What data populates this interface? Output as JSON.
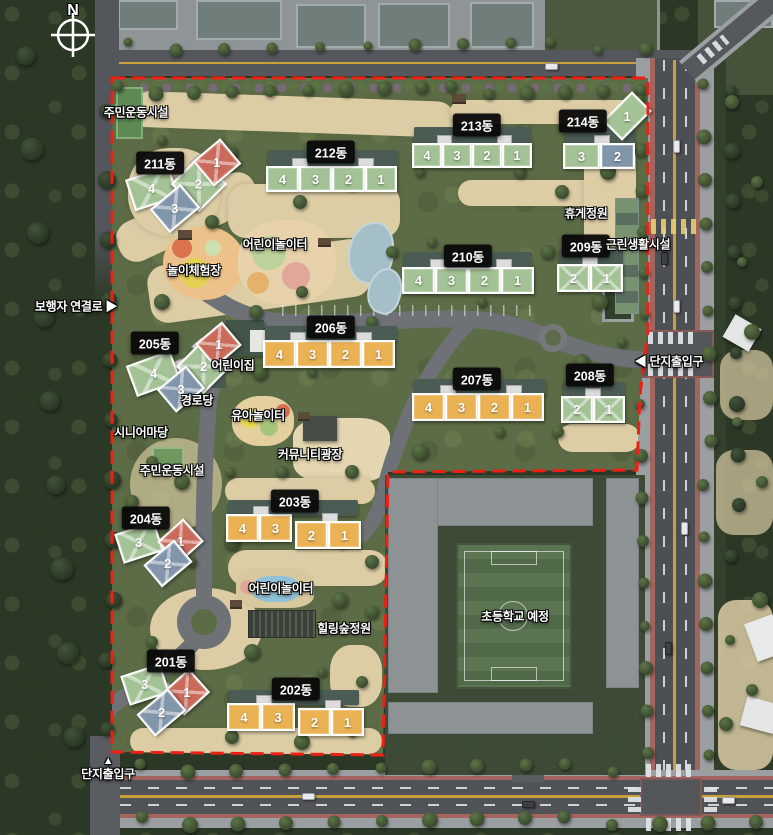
{
  "meta": {
    "compass": "N"
  },
  "colors": {
    "green": "#a3c295",
    "orange": "#ebb254",
    "red": "#c96a5a",
    "blue": "#8196aa",
    "boundary": "#ee1f14",
    "label_bg": "#0c0c0c"
  },
  "buildings": [
    {
      "name": "211동",
      "label": {
        "x": 160,
        "y": 163
      },
      "units": [
        {
          "n": "4",
          "c": "green",
          "x": 129,
          "y": 172,
          "w": 46,
          "h": 33,
          "r": -18,
          "cross": true
        },
        {
          "n": "2",
          "c": "green",
          "x": 179,
          "y": 164,
          "w": 40,
          "h": 40,
          "r": 45,
          "cross": true
        },
        {
          "n": "3",
          "c": "blue",
          "x": 155,
          "y": 193,
          "w": 40,
          "h": 31,
          "r": -40,
          "cross": true
        },
        {
          "n": "1",
          "c": "red",
          "x": 199,
          "y": 146,
          "w": 36,
          "h": 33,
          "r": -40,
          "cross": true
        }
      ],
      "tabs": [
        {
          "x": 170,
          "y": 177,
          "w": 15,
          "h": 11,
          "r": -20
        },
        {
          "x": 191,
          "y": 157,
          "w": 13,
          "h": 10,
          "r": -40
        }
      ]
    },
    {
      "name": "212동",
      "label": {
        "x": 331,
        "y": 152
      },
      "back": {
        "x": 268,
        "y": 150,
        "w": 130,
        "h": 18
      },
      "units": [
        {
          "n": "4",
          "c": "green",
          "x": 266,
          "y": 166,
          "w": 33,
          "h": 26
        },
        {
          "n": "3",
          "c": "green",
          "x": 299,
          "y": 166,
          "w": 33,
          "h": 26
        },
        {
          "n": "2",
          "c": "green",
          "x": 332,
          "y": 166,
          "w": 33,
          "h": 26
        },
        {
          "n": "1",
          "c": "green",
          "x": 365,
          "y": 166,
          "w": 32,
          "h": 26
        }
      ],
      "tabs": [
        {
          "x": 292,
          "y": 158,
          "w": 16,
          "h": 9
        },
        {
          "x": 358,
          "y": 158,
          "w": 16,
          "h": 9
        }
      ]
    },
    {
      "name": "213동",
      "label": {
        "x": 477,
        "y": 125
      },
      "back": {
        "x": 414,
        "y": 127,
        "w": 118,
        "h": 17
      },
      "units": [
        {
          "n": "4",
          "c": "green",
          "x": 412,
          "y": 143,
          "w": 30,
          "h": 25
        },
        {
          "n": "3",
          "c": "green",
          "x": 442,
          "y": 143,
          "w": 30,
          "h": 25
        },
        {
          "n": "2",
          "c": "green",
          "x": 472,
          "y": 143,
          "w": 30,
          "h": 25
        },
        {
          "n": "1",
          "c": "green",
          "x": 502,
          "y": 143,
          "w": 30,
          "h": 25
        }
      ],
      "tabs": [
        {
          "x": 437,
          "y": 135,
          "w": 15,
          "h": 9
        },
        {
          "x": 497,
          "y": 135,
          "w": 15,
          "h": 9
        }
      ]
    },
    {
      "name": "214동",
      "label": {
        "x": 583,
        "y": 121
      },
      "back": {
        "x": 565,
        "y": 128,
        "w": 70,
        "h": 16
      },
      "units": [
        {
          "n": "3",
          "c": "green",
          "x": 563,
          "y": 143,
          "w": 37,
          "h": 26
        },
        {
          "n": "2",
          "c": "blue",
          "x": 600,
          "y": 143,
          "w": 35,
          "h": 26
        },
        {
          "n": "1",
          "c": "green",
          "x": 606,
          "y": 102,
          "w": 42,
          "h": 28,
          "r": -45
        }
      ],
      "tabs": [
        {
          "x": 594,
          "y": 135,
          "w": 16,
          "h": 9
        }
      ]
    },
    {
      "name": "210동",
      "label": {
        "x": 468,
        "y": 256
      },
      "back": {
        "x": 404,
        "y": 252,
        "w": 128,
        "h": 16
      },
      "units": [
        {
          "n": "4",
          "c": "green",
          "x": 402,
          "y": 267,
          "w": 33,
          "h": 27
        },
        {
          "n": "3",
          "c": "green",
          "x": 435,
          "y": 267,
          "w": 33,
          "h": 27
        },
        {
          "n": "2",
          "c": "green",
          "x": 468,
          "y": 267,
          "w": 33,
          "h": 27
        },
        {
          "n": "1",
          "c": "green",
          "x": 501,
          "y": 267,
          "w": 33,
          "h": 27
        }
      ],
      "tabs": [
        {
          "x": 430,
          "y": 259,
          "w": 16,
          "h": 9
        },
        {
          "x": 496,
          "y": 259,
          "w": 16,
          "h": 9
        }
      ]
    },
    {
      "name": "209동",
      "label": {
        "x": 586,
        "y": 246
      },
      "back": {
        "x": 559,
        "y": 250,
        "w": 64,
        "h": 15
      },
      "units": [
        {
          "n": "2",
          "c": "green",
          "x": 557,
          "y": 264,
          "w": 33,
          "h": 28,
          "cross": true
        },
        {
          "n": "1",
          "c": "green",
          "x": 590,
          "y": 264,
          "w": 33,
          "h": 28,
          "cross": true
        }
      ],
      "tabs": [
        {
          "x": 582,
          "y": 256,
          "w": 16,
          "h": 9
        }
      ]
    },
    {
      "name": "206동",
      "label": {
        "x": 331,
        "y": 327
      },
      "back": {
        "x": 265,
        "y": 326,
        "w": 132,
        "h": 16
      },
      "units": [
        {
          "n": "4",
          "c": "orange",
          "x": 263,
          "y": 340,
          "w": 33,
          "h": 28
        },
        {
          "n": "3",
          "c": "orange",
          "x": 296,
          "y": 340,
          "w": 33,
          "h": 28
        },
        {
          "n": "2",
          "c": "orange",
          "x": 329,
          "y": 340,
          "w": 33,
          "h": 28
        },
        {
          "n": "1",
          "c": "orange",
          "x": 362,
          "y": 340,
          "w": 33,
          "h": 28
        }
      ],
      "tabs": [
        {
          "x": 290,
          "y": 332,
          "w": 16,
          "h": 9
        },
        {
          "x": 356,
          "y": 332,
          "w": 16,
          "h": 9
        }
      ]
    },
    {
      "name": "205동",
      "label": {
        "x": 155,
        "y": 343
      },
      "units": [
        {
          "n": "4",
          "c": "green",
          "x": 130,
          "y": 357,
          "w": 47,
          "h": 33,
          "r": -20,
          "cross": true
        },
        {
          "n": "2",
          "c": "green",
          "x": 184,
          "y": 347,
          "w": 39,
          "h": 39,
          "r": 45,
          "cross": true
        },
        {
          "n": "1",
          "c": "red",
          "x": 201,
          "y": 329,
          "w": 35,
          "h": 31,
          "r": -40,
          "cross": true
        },
        {
          "n": "3",
          "c": "blue",
          "x": 162,
          "y": 374,
          "w": 38,
          "h": 30,
          "r": -40,
          "cross": true
        }
      ],
      "tabs": [
        {
          "x": 172,
          "y": 360,
          "w": 15,
          "h": 11,
          "r": -20
        },
        {
          "x": 193,
          "y": 341,
          "w": 13,
          "h": 10,
          "r": -40
        }
      ]
    },
    {
      "name": "207동",
      "label": {
        "x": 477,
        "y": 379
      },
      "back": {
        "x": 414,
        "y": 379,
        "w": 132,
        "h": 16
      },
      "units": [
        {
          "n": "4",
          "c": "orange",
          "x": 412,
          "y": 393,
          "w": 33,
          "h": 28
        },
        {
          "n": "3",
          "c": "orange",
          "x": 445,
          "y": 393,
          "w": 33,
          "h": 28
        },
        {
          "n": "2",
          "c": "orange",
          "x": 478,
          "y": 393,
          "w": 33,
          "h": 28
        },
        {
          "n": "1",
          "c": "orange",
          "x": 511,
          "y": 393,
          "w": 33,
          "h": 28
        }
      ],
      "tabs": [
        {
          "x": 440,
          "y": 385,
          "w": 16,
          "h": 9
        },
        {
          "x": 506,
          "y": 385,
          "w": 16,
          "h": 9
        }
      ]
    },
    {
      "name": "208동",
      "label": {
        "x": 590,
        "y": 375
      },
      "back": {
        "x": 563,
        "y": 382,
        "w": 62,
        "h": 14
      },
      "units": [
        {
          "n": "2",
          "c": "green",
          "x": 561,
          "y": 396,
          "w": 32,
          "h": 27,
          "cross": true
        },
        {
          "n": "1",
          "c": "green",
          "x": 593,
          "y": 396,
          "w": 32,
          "h": 27,
          "cross": true
        }
      ],
      "tabs": [
        {
          "x": 585,
          "y": 388,
          "w": 16,
          "h": 9
        }
      ]
    },
    {
      "name": "204동",
      "label": {
        "x": 146,
        "y": 518
      },
      "units": [
        {
          "n": "3",
          "c": "green",
          "x": 118,
          "y": 527,
          "w": 42,
          "h": 31,
          "r": -18,
          "cross": true
        },
        {
          "n": "1",
          "c": "red",
          "x": 163,
          "y": 526,
          "w": 35,
          "h": 31,
          "r": -42,
          "cross": true
        },
        {
          "n": "2",
          "c": "blue",
          "x": 148,
          "y": 549,
          "w": 40,
          "h": 29,
          "r": -40,
          "cross": true
        }
      ],
      "tabs": [
        {
          "x": 153,
          "y": 539,
          "w": 14,
          "h": 11,
          "r": -30
        }
      ]
    },
    {
      "name": "203동",
      "label": {
        "x": 295,
        "y": 501
      },
      "back": {
        "x": 228,
        "y": 500,
        "w": 130,
        "h": 16
      },
      "units": [
        {
          "n": "4",
          "c": "orange",
          "x": 226,
          "y": 514,
          "w": 33,
          "h": 28
        },
        {
          "n": "3",
          "c": "orange",
          "x": 259,
          "y": 514,
          "w": 33,
          "h": 28
        },
        {
          "n": "2",
          "c": "orange",
          "x": 295,
          "y": 521,
          "w": 33,
          "h": 28
        },
        {
          "n": "1",
          "c": "orange",
          "x": 328,
          "y": 521,
          "w": 33,
          "h": 28
        }
      ],
      "tabs": [
        {
          "x": 253,
          "y": 506,
          "w": 16,
          "h": 9
        },
        {
          "x": 322,
          "y": 513,
          "w": 16,
          "h": 9
        }
      ]
    },
    {
      "name": "201동",
      "label": {
        "x": 171,
        "y": 661
      },
      "units": [
        {
          "n": "3",
          "c": "green",
          "x": 124,
          "y": 669,
          "w": 42,
          "h": 31,
          "r": -18,
          "cross": true
        },
        {
          "n": "1",
          "c": "red",
          "x": 169,
          "y": 676,
          "w": 35,
          "h": 32,
          "r": -42,
          "cross": true
        },
        {
          "n": "2",
          "c": "blue",
          "x": 141,
          "y": 698,
          "w": 41,
          "h": 29,
          "r": -40,
          "cross": true
        }
      ],
      "tabs": [
        {
          "x": 158,
          "y": 685,
          "w": 14,
          "h": 11,
          "r": -30
        }
      ]
    },
    {
      "name": "202동",
      "label": {
        "x": 296,
        "y": 689
      },
      "back": {
        "x": 229,
        "y": 690,
        "w": 130,
        "h": 15
      },
      "units": [
        {
          "n": "4",
          "c": "orange",
          "x": 227,
          "y": 703,
          "w": 34,
          "h": 28
        },
        {
          "n": "3",
          "c": "orange",
          "x": 261,
          "y": 703,
          "w": 34,
          "h": 28
        },
        {
          "n": "2",
          "c": "orange",
          "x": 298,
          "y": 708,
          "w": 33,
          "h": 28
        },
        {
          "n": "1",
          "c": "orange",
          "x": 331,
          "y": 708,
          "w": 33,
          "h": 28
        }
      ],
      "tabs": [
        {
          "x": 256,
          "y": 695,
          "w": 16,
          "h": 9
        },
        {
          "x": 325,
          "y": 700,
          "w": 16,
          "h": 9
        }
      ]
    }
  ],
  "facilities": [
    {
      "label": "주민운동시설",
      "x": 136,
      "y": 112
    },
    {
      "label": "어린이놀이터",
      "x": 275,
      "y": 244
    },
    {
      "label": "놀이체험장",
      "x": 194,
      "y": 270
    },
    {
      "label": "어린이집",
      "x": 233,
      "y": 365
    },
    {
      "label": "경로당",
      "x": 197,
      "y": 400
    },
    {
      "label": "시니어마당",
      "x": 141,
      "y": 432
    },
    {
      "label": "주민운동시설",
      "x": 172,
      "y": 470
    },
    {
      "label": "유아놀이터",
      "x": 258,
      "y": 415
    },
    {
      "label": "커뮤니티광장",
      "x": 310,
      "y": 454
    },
    {
      "label": "어린이놀이터",
      "x": 281,
      "y": 588
    },
    {
      "label": "힐링숲정원",
      "x": 344,
      "y": 628
    },
    {
      "label": "휴게정원",
      "x": 586,
      "y": 213
    },
    {
      "label": "근린생활시설",
      "x": 638,
      "y": 244
    },
    {
      "label": "초등학교 예정",
      "x": 515,
      "y": 616
    }
  ],
  "entrances": [
    {
      "label": "보행자 연결로",
      "arrow": "▶",
      "pos": "right",
      "x": 76,
      "y": 306
    },
    {
      "label": "단지출입구",
      "arrow": "◀",
      "pos": "left",
      "x": 669,
      "y": 361
    },
    {
      "label": "단지출입구",
      "arrow": "▲",
      "pos": "top",
      "x": 108,
      "y": 768
    }
  ]
}
